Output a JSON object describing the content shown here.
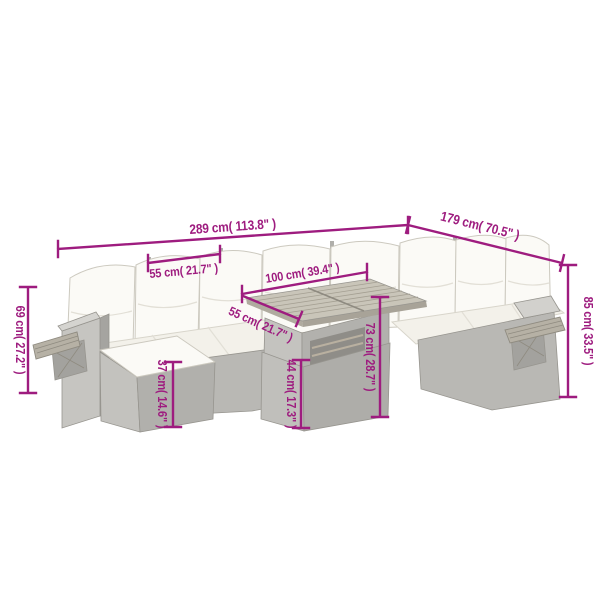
{
  "diagram": {
    "description": "Outdoor poly rattan corner sofa set with ottoman and cube table, annotated with product dimensions",
    "background": "#ffffff"
  },
  "colors": {
    "dimension_accent": "#9e1c7f",
    "rattan_light": "#d5d4d0",
    "rattan_mid": "#c1c0bc",
    "rattan_dark": "#aeada9",
    "cushion_white": "#fbfaf6",
    "seat_cream": "#f3f1ea",
    "wood": "#b6b1a5"
  },
  "dimensions": {
    "total_width": "289 cm( 113.8\" )",
    "total_depth": "179 cm( 70.5\" )",
    "seat_width": "55 cm( 21.7\" )",
    "table_width": "100 cm( 39.4\" )",
    "table_depth": "55 cm( 21.7\" )",
    "armrest_height": "69 cm( 27.2\" )",
    "back_height": "85 cm( 33.5\" )",
    "table_height": "73 cm( 28.7\" )",
    "table_base_height": "44 cm( 17.3\" )",
    "ottoman_height": "37 cm( 14.6\" )"
  }
}
